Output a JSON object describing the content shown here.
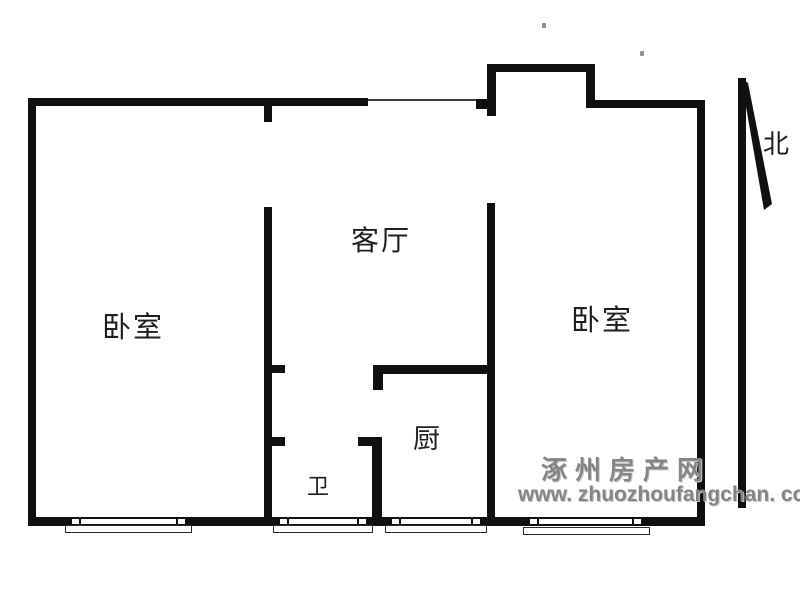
{
  "floorplan": {
    "rooms": [
      {
        "id": "bedroom-left",
        "label": "卧室"
      },
      {
        "id": "living-room",
        "label": "客厅"
      },
      {
        "id": "bedroom-right",
        "label": "卧室"
      },
      {
        "id": "kitchen",
        "label": "厨"
      },
      {
        "id": "bathroom",
        "label": "卫"
      }
    ],
    "compass": {
      "label": "北"
    },
    "watermark": {
      "site_name": "涿州房产网",
      "site_url": "www. zhuozhoufangchan. com",
      "color": "#858585"
    },
    "colors": {
      "wall": "#101010",
      "background": "#ffffff",
      "label": "#1e1e1e"
    }
  }
}
